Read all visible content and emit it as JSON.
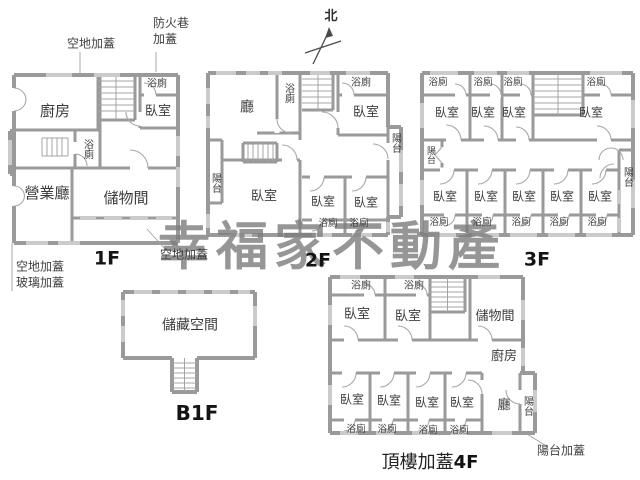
{
  "watermark": "幸福家不動產",
  "compass": {
    "north": "北"
  },
  "colors": {
    "wall": "#9a9a9b",
    "window": "#cbcbcd",
    "text": "#3c3c3c",
    "watermark": "#7d7d7d"
  },
  "annotations": {
    "open_top": "空地加蓋",
    "firelane": "防火巷\n加蓋",
    "open_bottom_right": "空地加蓋",
    "open_bottom_left": "空地加蓋",
    "glass_bottom_left": "玻璃加蓋",
    "balcony_cover": "陽台加蓋"
  },
  "floor1": {
    "label": "1F",
    "kitchen": "廚房",
    "bath_top": "浴廁",
    "bedroom": "臥室",
    "bath_mid": "浴廁",
    "sales_hall": "營業廳",
    "storage": "儲物間"
  },
  "floor2": {
    "label": "2F",
    "hall": "廳",
    "bath_vertical": "浴廁",
    "bath_top_right": "浴廁",
    "bedroom_top_right": "臥室",
    "balcony_right": "陽台",
    "balcony_left": "陽台",
    "bedroom_main": "臥室",
    "bedroom_bottom_1": "臥室",
    "bedroom_bottom_2": "臥室",
    "bath_bottom_1": "浴廁",
    "bath_bottom_2": "浴廁"
  },
  "floor3": {
    "label": "3F",
    "baths_top": [
      "浴廁",
      "浴廁",
      "浴廁",
      "浴廁"
    ],
    "bedrooms_top": [
      "臥室",
      "臥室",
      "臥室",
      "臥室"
    ],
    "balcony_left": "陽台",
    "balcony_right": "陽台",
    "bedrooms_bottom": [
      "臥室",
      "臥室",
      "臥室",
      "臥室",
      "臥室"
    ],
    "baths_bottom": [
      "浴廁",
      "浴廁",
      "浴廁",
      "浴廁",
      "浴廁"
    ]
  },
  "floorB1": {
    "label": "B1F",
    "storage_space": "儲藏空間"
  },
  "floor4": {
    "label_prefix": "頂樓加蓋",
    "label": "4F",
    "baths_top": [
      "浴廁",
      "浴廁"
    ],
    "bedrooms_top": [
      "臥室",
      "臥室"
    ],
    "storage": "儲物間",
    "kitchen": "廚房",
    "bedrooms_bottom": [
      "臥室",
      "臥室",
      "臥室",
      "臥室"
    ],
    "hall": "廳",
    "balcony": "陽台",
    "baths_bottom": [
      "浴廁",
      "浴廁",
      "浴廁",
      "浴廁"
    ]
  }
}
